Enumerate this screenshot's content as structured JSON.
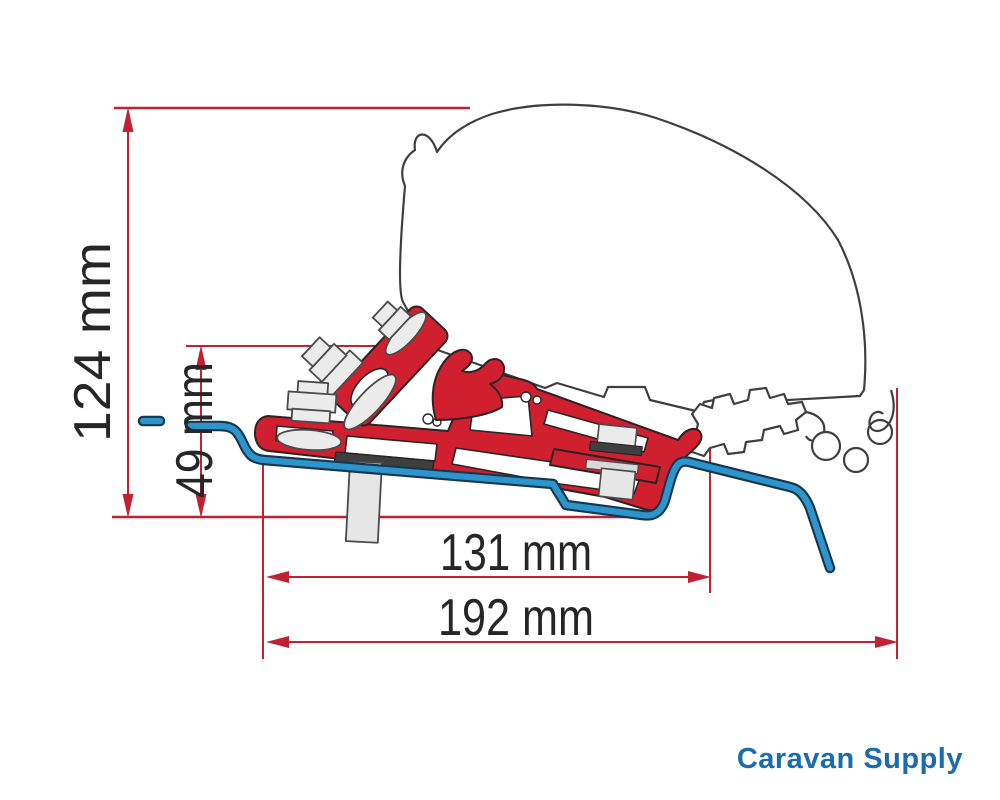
{
  "diagram": {
    "type": "technical-dimension-drawing",
    "dimensions": {
      "overall_height": {
        "label": "124 mm",
        "value": 124,
        "unit": "mm",
        "orientation": "vertical"
      },
      "bracket_height": {
        "label": "49 mm",
        "value": 49,
        "unit": "mm",
        "orientation": "vertical"
      },
      "inner_width": {
        "label": "131 mm",
        "value": 131,
        "unit": "mm",
        "orientation": "horizontal"
      },
      "overall_width": {
        "label": "192 mm",
        "value": 192,
        "unit": "mm",
        "orientation": "horizontal"
      }
    },
    "colors": {
      "dimension_lines": "#c22132",
      "bracket_red": "#d02030",
      "roof_profile_blue": "#2e95cc",
      "outline_gray": "#3f3f41",
      "hardware_gray": "#ebebeb",
      "label_text": "#262626",
      "background": "#ffffff"
    }
  },
  "logo": {
    "text": "Caravan Supply",
    "color": "#1c6bad"
  }
}
